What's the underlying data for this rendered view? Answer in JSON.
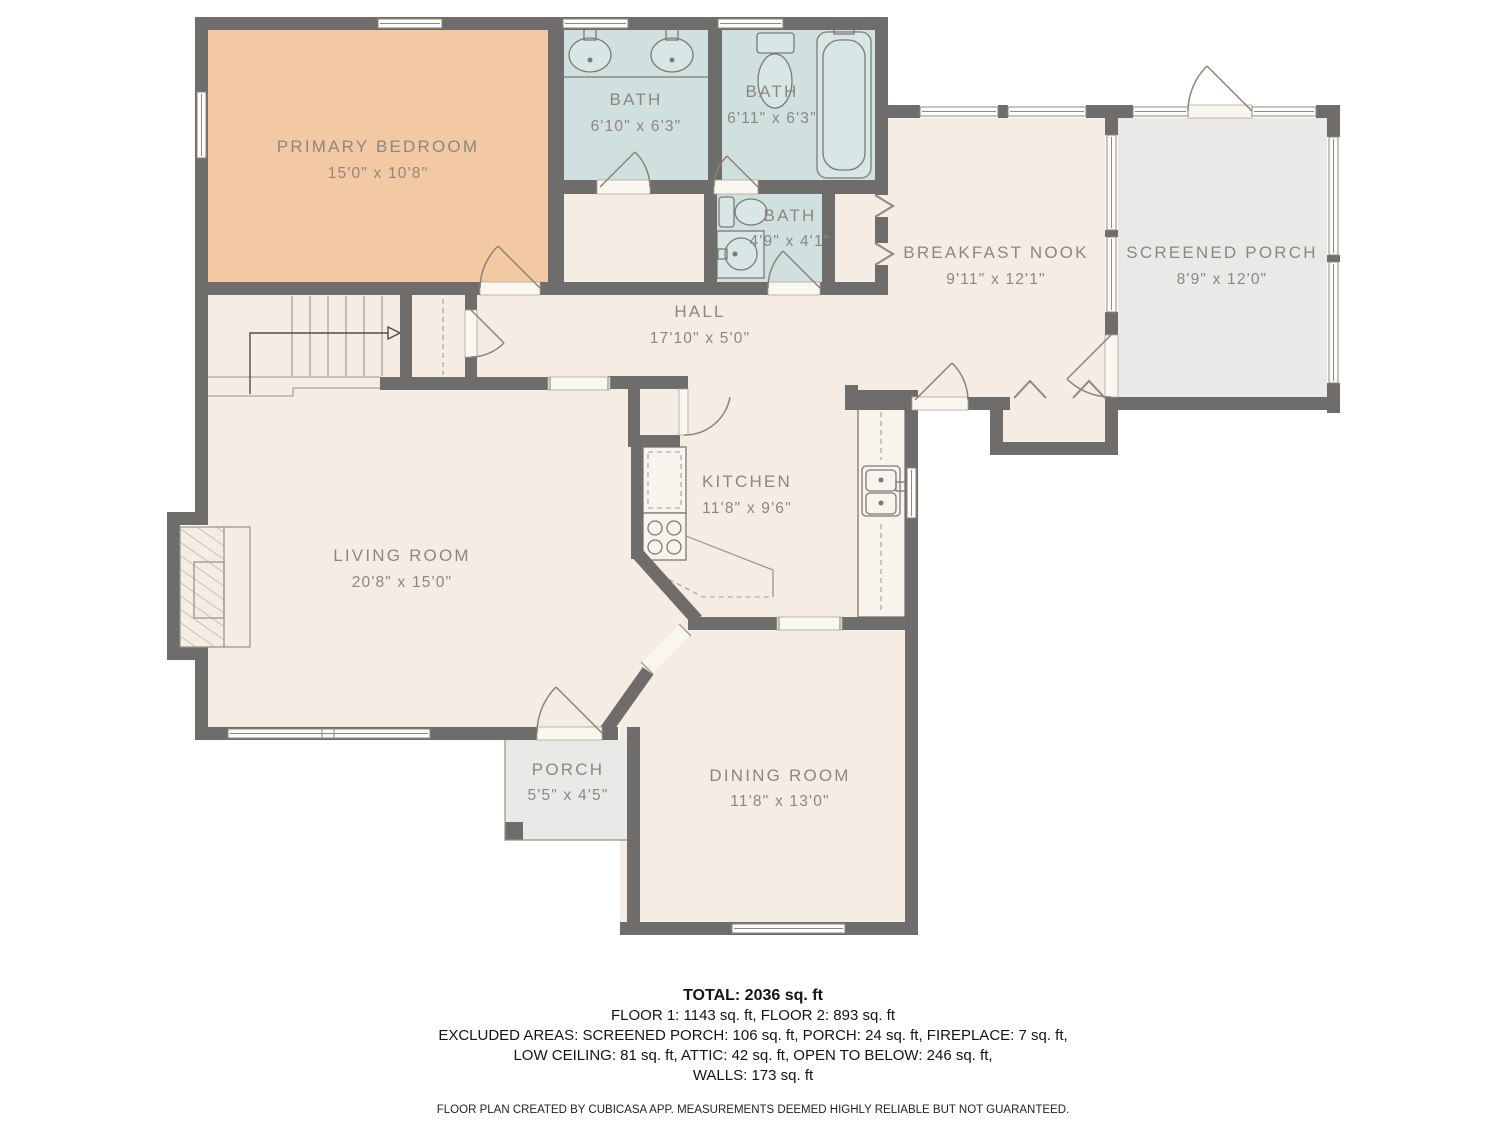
{
  "rooms": {
    "primary_bedroom": {
      "name": "PRIMARY BEDROOM",
      "dims": "15'0\" x 10'8\""
    },
    "bath_1": {
      "name": "BATH",
      "dims": "6'10\" x 6'3\""
    },
    "bath_2": {
      "name": "BATH",
      "dims": "6'11\" x 6'3\""
    },
    "bath_3": {
      "name": "BATH",
      "dims": "4'9\" x 4'1\""
    },
    "hall": {
      "name": "HALL",
      "dims": "17'10\" x 5'0\""
    },
    "breakfast_nook": {
      "name": "BREAKFAST NOOK",
      "dims": "9'11\" x 12'1\""
    },
    "screened_porch": {
      "name": "SCREENED PORCH",
      "dims": "8'9\" x 12'0\""
    },
    "kitchen": {
      "name": "KITCHEN",
      "dims": "11'8\" x 9'6\""
    },
    "living_room": {
      "name": "LIVING ROOM",
      "dims": "20'8\" x 15'0\""
    },
    "porch": {
      "name": "PORCH",
      "dims": "5'5\" x 4'5\""
    },
    "dining_room": {
      "name": "DINING ROOM",
      "dims": "11'8\" x 13'0\""
    }
  },
  "summary": {
    "total": "TOTAL: 2036 sq. ft",
    "floors": "FLOOR 1: 1143 sq. ft, FLOOR 2: 893 sq. ft",
    "excluded_line1": "EXCLUDED AREAS: SCREENED PORCH: 106 sq. ft, PORCH: 24 sq. ft, FIREPLACE: 7 sq. ft,",
    "excluded_line2": "LOW CEILING: 81 sq. ft, ATTIC: 42 sq. ft, OPEN TO BELOW: 246 sq. ft,",
    "excluded_line3": "WALLS: 173 sq. ft",
    "disclaimer": "FLOOR PLAN CREATED BY CUBICASA APP. MEASUREMENTS DEEMED HIGHLY RELIABLE BUT NOT GUARANTEED."
  },
  "colors": {
    "wall": "#6e6d6b",
    "room": "#f5ece3",
    "bedroom": "#f2c9a2",
    "bathroom": "#cfe0df",
    "porch": "#e9e9e7",
    "label_text": "#8d8780"
  }
}
